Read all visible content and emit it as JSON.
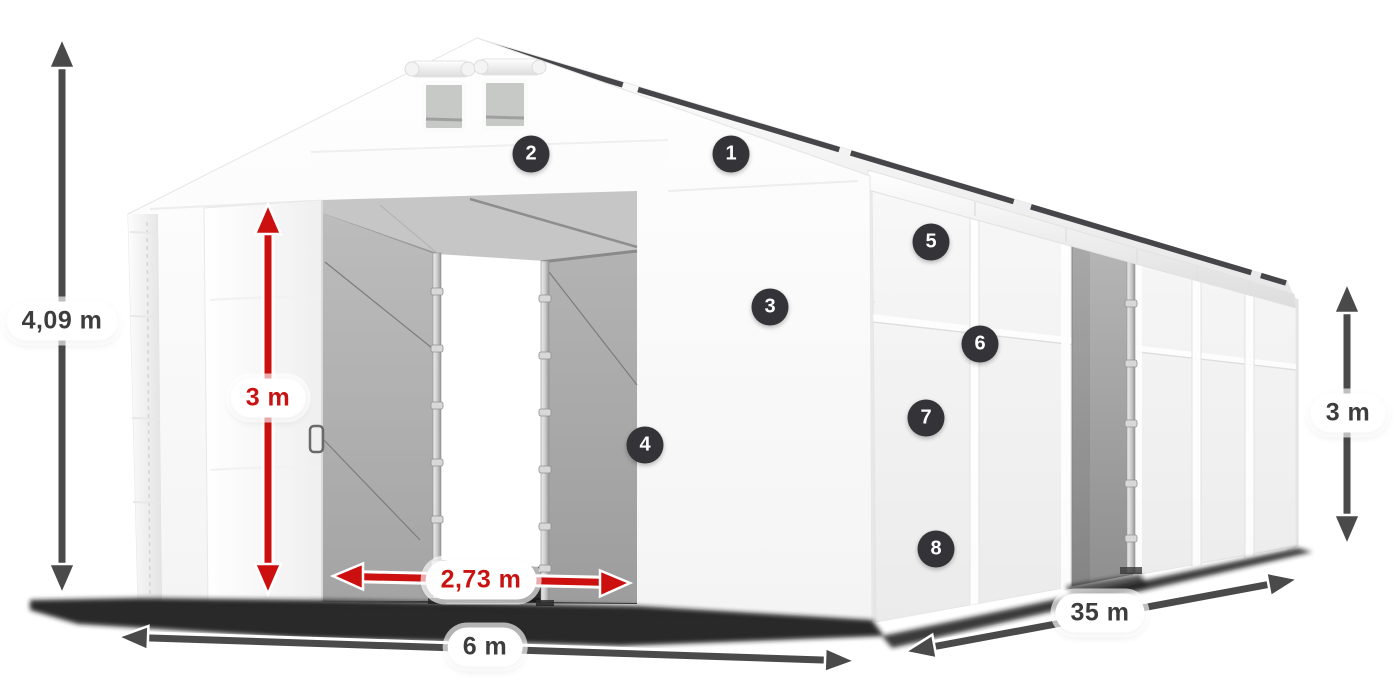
{
  "figure": {
    "type": "product-dimension-diagram",
    "subject": "white PVC storage tent with sliding entrance doors and side door"
  },
  "colors": {
    "dimension_dark": "#4a4a4a",
    "dimension_red": "#cb100f",
    "pill_background": "#ffffff",
    "pill_text_dark": "#3d3d3d",
    "pill_text_red": "#c81312",
    "badge_background": "#333338",
    "badge_text": "#ffffff"
  },
  "dimensions": [
    {
      "id": "total-height",
      "label": "4,09 m",
      "color_role": "dark",
      "orientation": "vertical"
    },
    {
      "id": "door-height",
      "label": "3 m",
      "color_role": "red",
      "orientation": "vertical"
    },
    {
      "id": "door-width",
      "label": "2,73 m",
      "color_role": "red",
      "orientation": "horizontal"
    },
    {
      "id": "width",
      "label": "6 m",
      "color_role": "dark",
      "orientation": "horizontal"
    },
    {
      "id": "length",
      "label": "35 m",
      "color_role": "dark",
      "orientation": "diagonal"
    },
    {
      "id": "side-height",
      "label": "3 m",
      "color_role": "dark",
      "orientation": "vertical"
    }
  ],
  "badges": [
    {
      "label": "1"
    },
    {
      "label": "2"
    },
    {
      "label": "3"
    },
    {
      "label": "4"
    },
    {
      "label": "5"
    },
    {
      "label": "6"
    },
    {
      "label": "7"
    },
    {
      "label": "8"
    }
  ]
}
